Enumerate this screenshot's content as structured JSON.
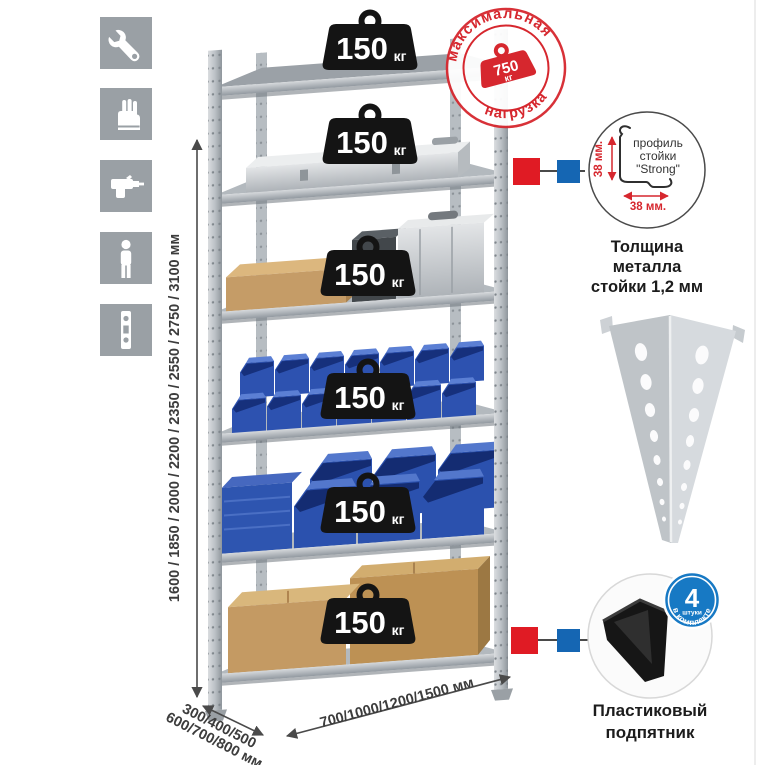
{
  "sidebar": {
    "icons": [
      {
        "name": "wrench-icon"
      },
      {
        "name": "gloves-icon"
      },
      {
        "name": "drill-icon"
      },
      {
        "name": "person-icon"
      },
      {
        "name": "perforated-post-icon"
      }
    ]
  },
  "rack": {
    "shelf_count": 6,
    "shelf_badge": {
      "value": "150",
      "unit": "кг"
    },
    "stamp": {
      "arc_top": "максимальная",
      "arc_bottom": "нагрузка",
      "value": "750",
      "unit": "кг"
    }
  },
  "dimensions": {
    "height": "1600 / 1850 / 2000 / 2200 / 2350 / 2550 / 2750 / 3100 мм",
    "depth_line1": "300/400/500",
    "depth_line2": "600/700/800 мм",
    "width": "700/1000/1200/1500 мм"
  },
  "profile_detail": {
    "dim_vertical": "38 мм.",
    "dim_horizontal": "38 мм.",
    "label_line1": "профиль",
    "label_line2": "стойки",
    "label_line3": "\"Strong\"",
    "caption_line1": "Толщина металла",
    "caption_line2": "стойки 1,2 мм"
  },
  "foot_detail": {
    "badge_value": "4",
    "badge_unit": "штуки",
    "badge_arc": "в комплекте",
    "caption_line1": "Пластиковый",
    "caption_line2": "подпятник"
  },
  "colors": {
    "accent_red": "#d6272e",
    "marker_red": "#e01b24",
    "marker_blue": "#1566b3",
    "badge_black": "#141414",
    "bin_blue": "#2d52b0",
    "kit_badge_blue": "#1779c4",
    "icon_gray": "#9aa0a5"
  }
}
